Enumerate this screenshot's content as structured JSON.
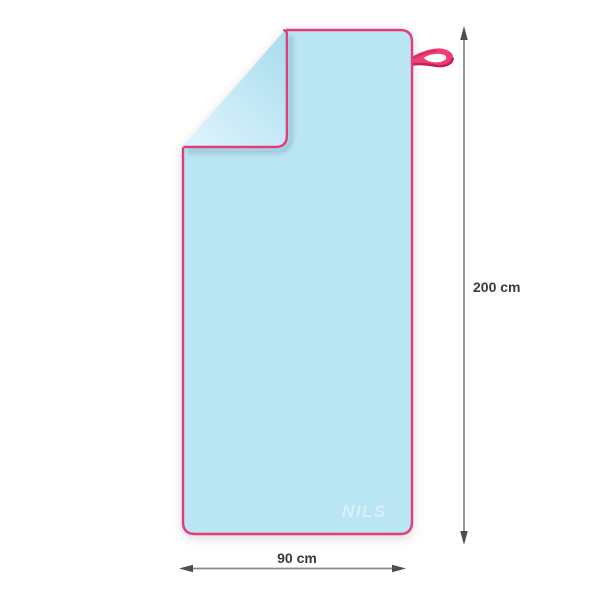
{
  "product": {
    "brand": "NILS",
    "height_label": "200 cm",
    "width_label": "90 cm"
  },
  "icons": {
    "height_arrow": "double-headed-vertical-arrow",
    "width_arrow": "double-headed-horizontal-arrow"
  },
  "colors": {
    "towel_fill": "#bae5f3",
    "towel_flap_dark": "#abdeef",
    "towel_flap_light": "#d9f2fb",
    "border_pink": "#e23d7b",
    "loop_pink": "#f23d73",
    "loop_dark": "#bd2057",
    "dimension_line": "#8a8a8a",
    "dimension_arrowhead": "#4f4f4f",
    "label_text": "#3b3b3b",
    "logo_white": "#ffffff"
  }
}
